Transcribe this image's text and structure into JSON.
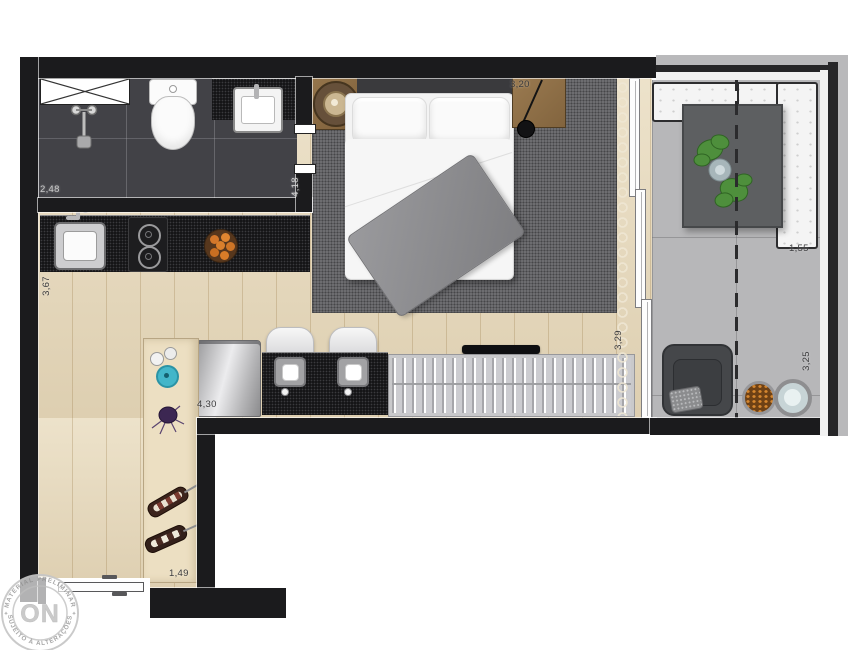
{
  "meta": {
    "type": "studio-apartment-floor-plan"
  },
  "dimensions": {
    "bathroom_width": "2,48",
    "bathroom_length": "4,18",
    "kitchen_depth": "3,67",
    "kitchen_length": "4,30",
    "entry_width": "1,49",
    "bedroom_width": "3,20",
    "living_length": "3,29",
    "balcony_length": "3,25",
    "balcony_width": "1,55"
  },
  "watermark": {
    "arc_top": "MATERIAL PRELIMINAR",
    "arc_bottom": "SUJEITO À ALTERAÇÕES",
    "center": "ON",
    "separator": "✦"
  },
  "colors": {
    "wall": "#1b1b1d",
    "wood_floor": "#e9dcbf",
    "bathroom_floor": "#424247",
    "granite_counter": "#141416",
    "bedroom_rug": "#727275",
    "balcony_floor": "#b7b7b9",
    "sofa_white": "#f4f4f4",
    "table_gray": "#5d5f61",
    "plant_green": "#4e8f3c",
    "wood_furniture": "#8f7148",
    "accent_teal": "#43b6c9"
  }
}
